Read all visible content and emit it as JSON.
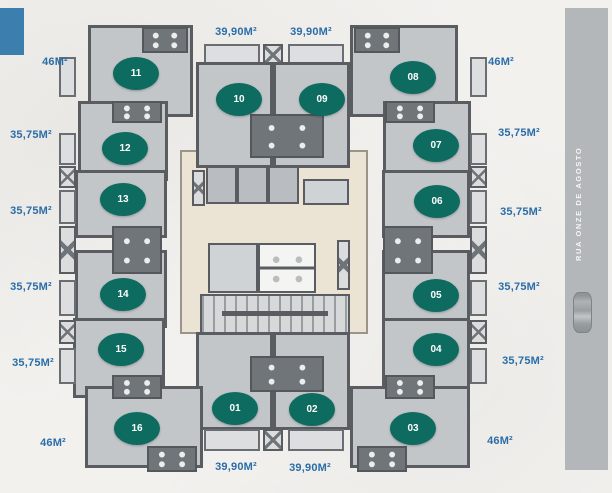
{
  "floor_plan": {
    "street_label": "RUA ONZE DE AGOSTO",
    "colors": {
      "accent_teal": "#0e6b60",
      "label_blue": "#2b6da8",
      "logo_blue": "#3c7fae",
      "street_gray": "#b4b7b9"
    },
    "units": [
      {
        "number": "01",
        "cx": 235,
        "cy": 408
      },
      {
        "number": "02",
        "cx": 312,
        "cy": 409
      },
      {
        "number": "03",
        "cx": 413,
        "cy": 428
      },
      {
        "number": "04",
        "cx": 436,
        "cy": 349
      },
      {
        "number": "05",
        "cx": 436,
        "cy": 295
      },
      {
        "number": "06",
        "cx": 437,
        "cy": 201
      },
      {
        "number": "07",
        "cx": 436,
        "cy": 145
      },
      {
        "number": "08",
        "cx": 413,
        "cy": 77
      },
      {
        "number": "09",
        "cx": 322,
        "cy": 99
      },
      {
        "number": "10",
        "cx": 239,
        "cy": 99
      },
      {
        "number": "11",
        "cx": 136,
        "cy": 73
      },
      {
        "number": "12",
        "cx": 125,
        "cy": 148
      },
      {
        "number": "13",
        "cx": 123,
        "cy": 199
      },
      {
        "number": "14",
        "cx": 123,
        "cy": 294
      },
      {
        "number": "15",
        "cx": 121,
        "cy": 349
      },
      {
        "number": "16",
        "cx": 137,
        "cy": 428
      }
    ],
    "area_labels": [
      {
        "text": "46M²",
        "cx": 55,
        "cy": 62
      },
      {
        "text": "39,90M²",
        "cx": 236,
        "cy": 32
      },
      {
        "text": "39,90M²",
        "cx": 311,
        "cy": 32
      },
      {
        "text": "46M²",
        "cx": 501,
        "cy": 62
      },
      {
        "text": "35,75M²",
        "cx": 31,
        "cy": 135
      },
      {
        "text": "35,75M²",
        "cx": 31,
        "cy": 211
      },
      {
        "text": "35,75M²",
        "cx": 31,
        "cy": 287
      },
      {
        "text": "35,75M²",
        "cx": 33,
        "cy": 363
      },
      {
        "text": "46M²",
        "cx": 53,
        "cy": 443
      },
      {
        "text": "35,75M²",
        "cx": 519,
        "cy": 133
      },
      {
        "text": "35,75M²",
        "cx": 521,
        "cy": 212
      },
      {
        "text": "35,75M²",
        "cx": 519,
        "cy": 287
      },
      {
        "text": "35,75M²",
        "cx": 523,
        "cy": 361
      },
      {
        "text": "46M²",
        "cx": 500,
        "cy": 441
      },
      {
        "text": "39,90M²",
        "cx": 236,
        "cy": 467
      },
      {
        "text": "39,90M²",
        "cx": 310,
        "cy": 468
      }
    ]
  }
}
